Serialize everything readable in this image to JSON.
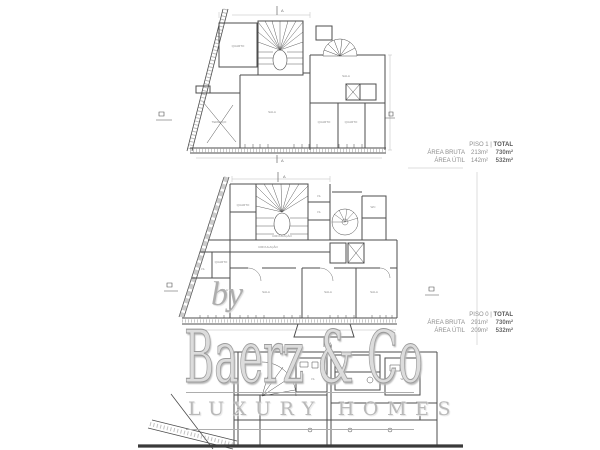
{
  "watermark": {
    "by": "by",
    "brand": "Baerz & Co",
    "tagline": "LUXURY HOMES"
  },
  "area_blocks": [
    {
      "floor": "PISO 1 |",
      "total_label": "TOTAL",
      "rows": [
        {
          "label": "ÁREA BRUTA",
          "floor_value": "213m²",
          "total_value": "730m²"
        },
        {
          "label": "ÁREA ÚTIL",
          "floor_value": "142m²",
          "total_value": "532m²"
        }
      ]
    },
    {
      "floor": "PISO 0 |",
      "total_label": "TOTAL",
      "rows": [
        {
          "label": "ÁREA BRUTA",
          "floor_value": "291m²",
          "total_value": "730m²"
        },
        {
          "label": "ÁREA ÚTIL",
          "floor_value": "209m²",
          "total_value": "532m²"
        }
      ]
    }
  ],
  "plans": {
    "section_marker": "A",
    "piso1": {
      "room_labels": [
        "QUARTO",
        "SALA",
        "QUARTO",
        "QUARTO",
        "SALA",
        "TERRAÇO"
      ]
    },
    "piso0": {
      "room_labels": [
        "QUARTO",
        "I.S.",
        "I.S.",
        "WC",
        "CIRCULAÇÃO",
        "CIRCULAÇÃO",
        "QUARTO",
        "I.S.",
        "SALA",
        "SALA",
        "SALA",
        "SALA"
      ]
    },
    "piso_lower": {
      "room_labels": [
        "I.S.",
        "WC"
      ]
    }
  },
  "colors": {
    "wall": "#4d4d4d",
    "thin": "#8f8f8f",
    "dim": "#b5b5b5",
    "ground": "#3a3a3a"
  }
}
